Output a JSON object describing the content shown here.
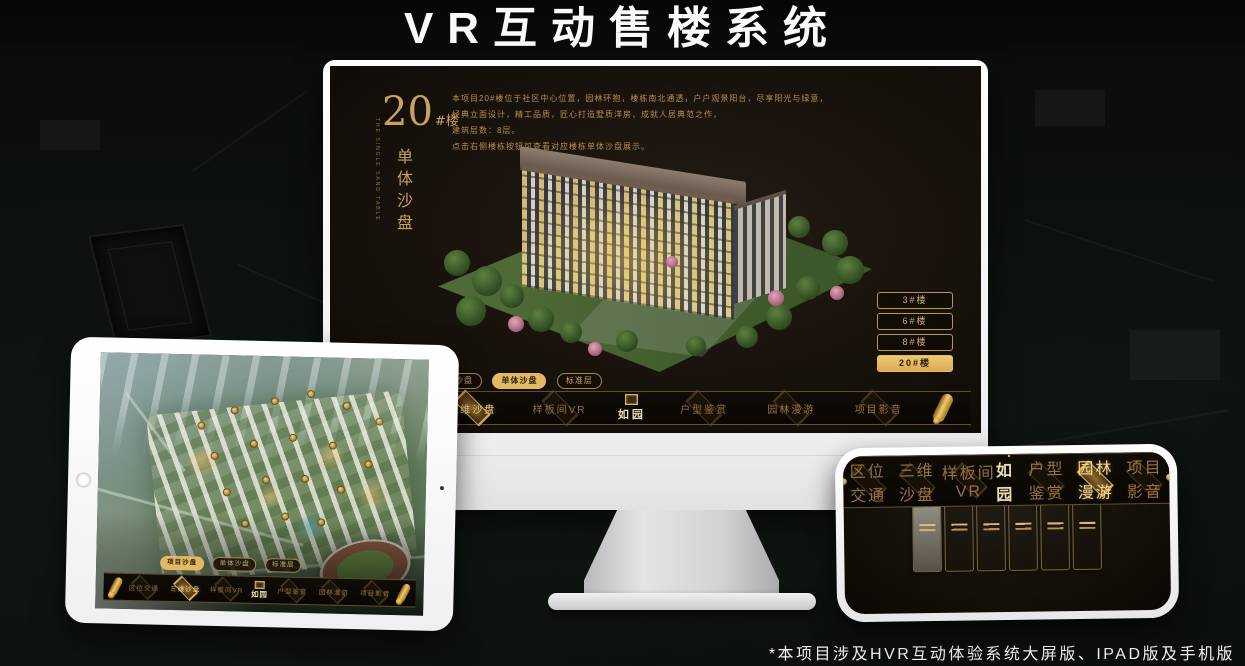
{
  "page": {
    "title": "VR互动售楼系统",
    "footnote": "*本项目涉及HVR互动体验系统大屏版、IPAD版及手机版"
  },
  "colors": {
    "gold": "#c9a25f",
    "gold_bright": "#e3b964",
    "screen_bg": "#18120c",
    "title_text": "#fafafa"
  },
  "desktop": {
    "heading": {
      "number": "20",
      "suffix": "#楼",
      "vertical": "单体沙盘",
      "vertical_en": "THE SINGLE SAND TABLE"
    },
    "description_lines": [
      "本项目20#楼位于社区中心位置，园林环抱，楼栋南北通透，户户观景阳台，尽享阳光与绿意，",
      "经典立面设计，精工品质，匠心打造墅质洋房，成就人居典范之作，",
      "建筑层数：8层。",
      "点击右侧楼栋按钮可查看对应楼栋单体沙盘展示。"
    ],
    "floor_buttons": [
      {
        "label": "3#楼",
        "active": false
      },
      {
        "label": "6#楼",
        "active": false
      },
      {
        "label": "8#楼",
        "active": false
      },
      {
        "label": "20#楼",
        "active": true
      }
    ],
    "sub_tabs": [
      {
        "label": "项目沙盘",
        "active": false
      },
      {
        "label": "单体沙盘",
        "active": true
      },
      {
        "label": "标准层",
        "active": false
      }
    ],
    "nav": {
      "logo": "如园",
      "items": [
        {
          "label": "区位交通",
          "active": false
        },
        {
          "label": "三维沙盘",
          "active": true
        },
        {
          "label": "样板间VR",
          "active": false
        },
        {
          "label": "户型鉴赏",
          "active": false
        },
        {
          "label": "园林漫游",
          "active": false
        },
        {
          "label": "项目影音",
          "active": false
        }
      ]
    }
  },
  "tablet": {
    "sub_tabs": [
      {
        "label": "项目沙盘",
        "active": true
      },
      {
        "label": "单体沙盘",
        "active": false
      },
      {
        "label": "标准层",
        "active": false
      }
    ],
    "nav": {
      "logo": "如园",
      "items": [
        {
          "label": "区位交通",
          "active": false
        },
        {
          "label": "三维沙盘",
          "active": true
        },
        {
          "label": "样板间VR",
          "active": false
        },
        {
          "label": "户型鉴赏",
          "active": false
        },
        {
          "label": "园林漫游",
          "active": false
        },
        {
          "label": "项目影音",
          "active": false
        }
      ]
    }
  },
  "phone": {
    "nav": {
      "logo": "如园",
      "items": [
        {
          "label": "区位交通",
          "active": false
        },
        {
          "label": "三维沙盘",
          "active": false
        },
        {
          "label": "样板间VR",
          "active": false
        },
        {
          "label": "户型鉴赏",
          "active": false
        },
        {
          "label": "园林漫游",
          "active": true
        },
        {
          "label": "项目影音",
          "active": false
        }
      ]
    },
    "gallery_cards": 6
  }
}
